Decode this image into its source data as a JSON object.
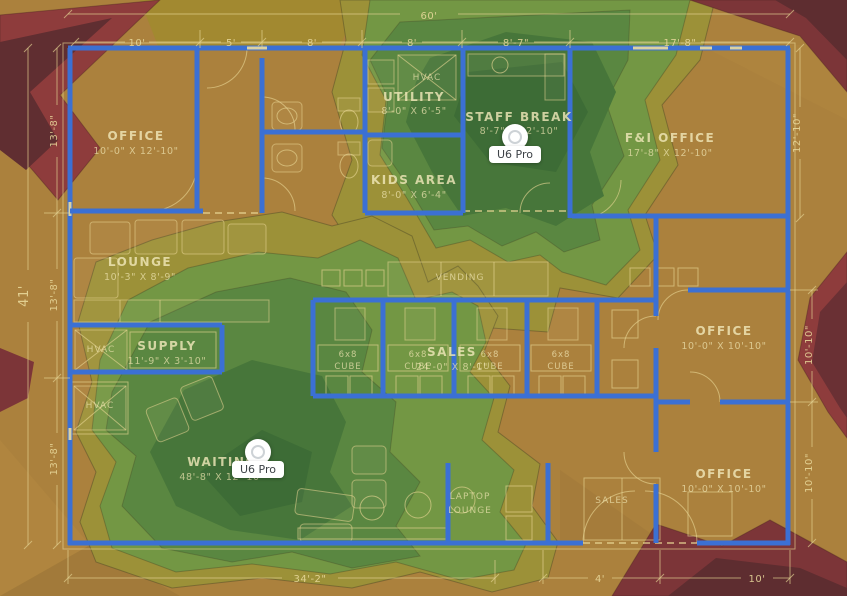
{
  "plan": {
    "rooms": [
      {
        "name": "OFFICE",
        "dims": "10'-0\" X 12'-10\""
      },
      {
        "name": "UTILITY",
        "dims": "8'-0\" X 6'-5\""
      },
      {
        "name": "STAFF BREAK",
        "dims": "8'-7\" X 12'-10\""
      },
      {
        "name": "F&I OFFICE",
        "dims": "17'-8\" X 12'-10\""
      },
      {
        "name": "KIDS AREA",
        "dims": "8'-0\" X 6'-4\""
      },
      {
        "name": "LOUNGE",
        "dims": "10'-3\" X 8'-9\""
      },
      {
        "name": "SUPPLY",
        "dims": "11'-9\" X 3'-10\""
      },
      {
        "name": "SALES",
        "dims": "24'-0\" X 8'-1\""
      },
      {
        "name": "WAITING",
        "dims": "48'-8\" X 12'-10\""
      },
      {
        "name": "OFFICE",
        "dims": "10'-0\" X 10'-10\""
      },
      {
        "name": "OFFICE",
        "dims": "10'-0\" X 10'-10\""
      }
    ],
    "small_labels": {
      "hvac": "HVAC",
      "vending": "VENDING",
      "sales_desk": "SALES",
      "laptop_line1": "LAPTOP",
      "laptop_line2": "LOUNGE",
      "cube_size": "6x8",
      "cube_word": "CUBE"
    },
    "dimensions": {
      "top_total": "60'",
      "top": [
        "10'",
        "5'",
        "8'",
        "8'",
        "8'-7\"",
        "17'-8\""
      ],
      "left_total": "41'",
      "left": [
        "13'-8\"",
        "13'-8\"",
        "13'-8\""
      ],
      "right": [
        "12'-10\"",
        "10'-10\"",
        "10'-10\""
      ],
      "bottom": [
        "34'-2\"",
        "4'",
        "10'"
      ]
    }
  },
  "access_points": [
    {
      "model": "U6 Pro"
    },
    {
      "model": "U6 Pro"
    }
  ],
  "heatmap_colors": {
    "signal_strongest": "#3d6c36",
    "signal_strong": "#47763a",
    "signal_good": "#5a8741",
    "signal_fair": "#739744",
    "signal_weak_olive": "#9c9138",
    "signal_base_amber": "#ab813d",
    "signal_poor_red": "#7c3538",
    "signal_dead_maroon": "#5e2d30",
    "wall_blue": "#3b70d4",
    "plan_linework": "#e9d99c"
  }
}
